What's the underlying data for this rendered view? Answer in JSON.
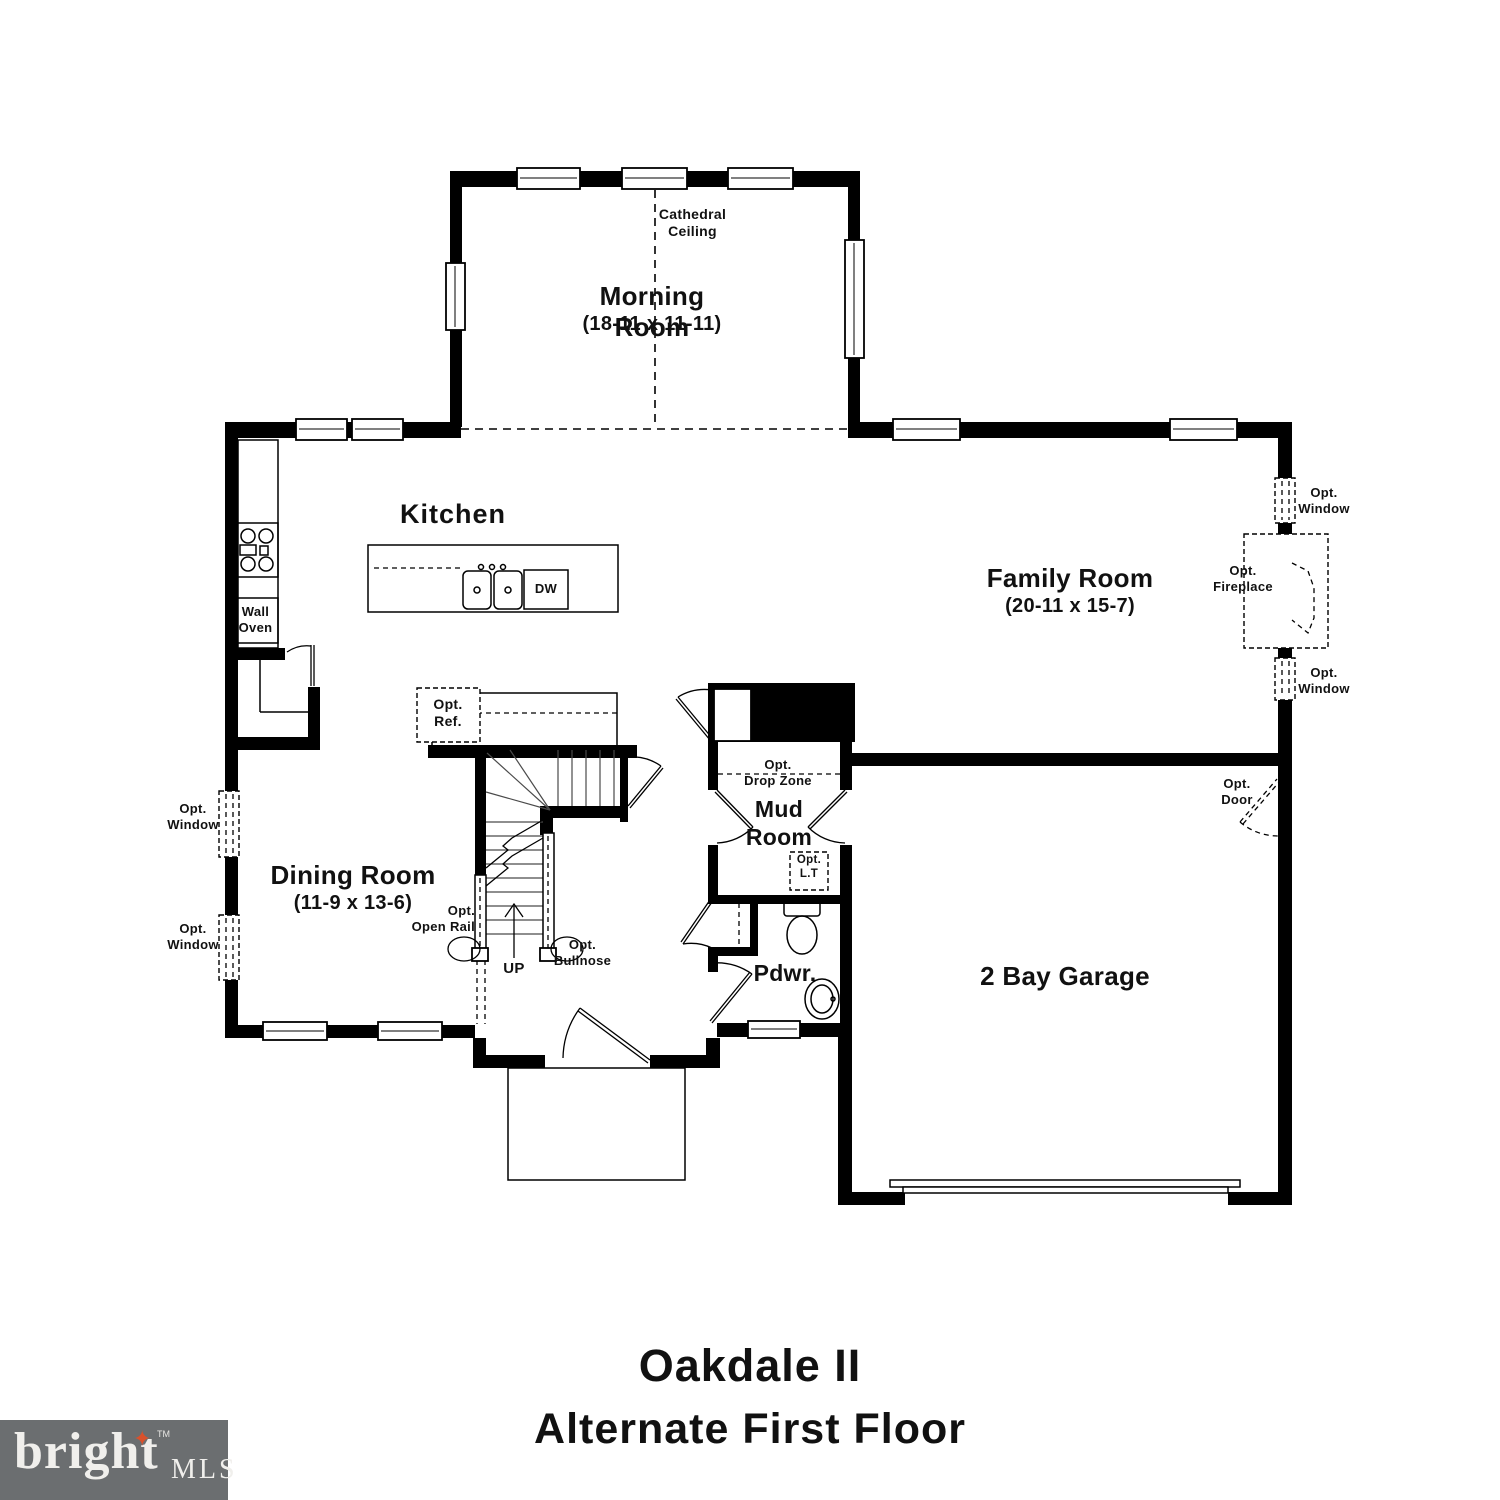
{
  "title": {
    "line1": "Oakdale II",
    "line2": "Alternate First Floor"
  },
  "logo": {
    "brand": "bright",
    "tm": "TM",
    "suffix": "MLS",
    "star_icon": "four-point-star"
  },
  "rooms": {
    "morning": {
      "name": "Morning Room",
      "dims": "(18-11 x 11-11)"
    },
    "kitchen": {
      "name": "Kitchen"
    },
    "family": {
      "name": "Family Room",
      "dims": "(20-11 x 15-7)"
    },
    "dining": {
      "name": "Dining Room",
      "dims": "(11-9 x 13-6)"
    },
    "mud": {
      "name": "Mud Room"
    },
    "pdwr": {
      "name": "Pdwr."
    },
    "garage": {
      "name": "2 Bay Garage"
    }
  },
  "annotations": {
    "cathedral": "Cathedral\nCeiling",
    "wall_oven": "Wall\nOven",
    "dw": "DW",
    "opt_ref": "Opt.\nRef.",
    "opt_window": "Opt.\nWindow",
    "opt_fireplace": "Opt.\nFireplace",
    "opt_door": "Opt.\nDoor",
    "opt_drop_zone": "Opt.\nDrop Zone",
    "opt_lt": "Opt.\nL.T",
    "opt_open_rail": "Opt.\nOpen Rail",
    "opt_bullnose": "Opt.\nBullnose",
    "up": "UP"
  },
  "colors": {
    "wall": "#000000",
    "text": "#111111",
    "logo_bg": "#6b6e70",
    "logo_fg": "#f0efec",
    "logo_accent": "#d9512c"
  }
}
